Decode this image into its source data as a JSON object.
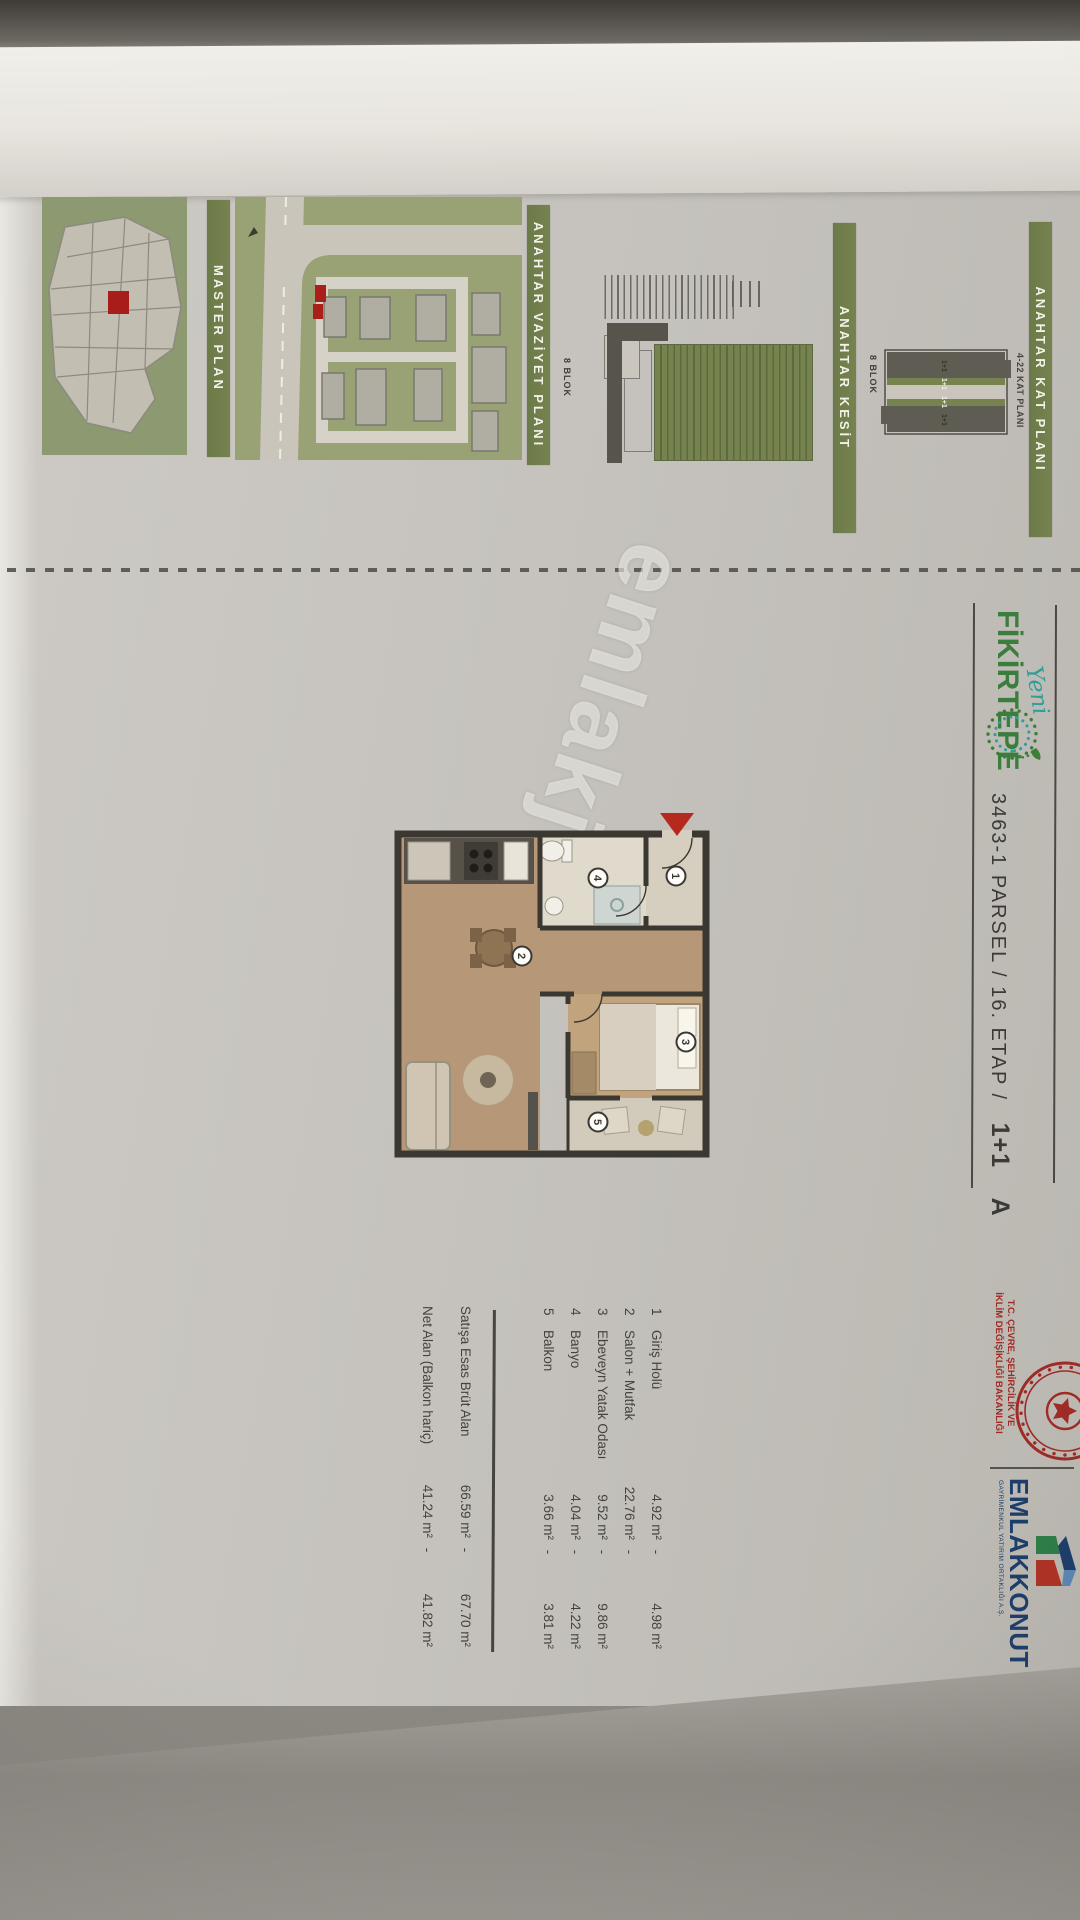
{
  "photo": {
    "watermark": "emlakjet.com"
  },
  "header": {
    "brand_script": "Yeni",
    "brand": "FİKİRTEPE",
    "title": "3463-1 PARSEL / 16. ETAP /",
    "unit_type": "1+1",
    "variant": "A"
  },
  "ministry": {
    "line1": "T.C. ÇEVRE, ŞEHİRCİLİK VE",
    "line2": "İKLİM DEĞİŞİKLİĞİ BAKANLIĞI"
  },
  "developer": {
    "name": "EMLAKKONUT",
    "subtitle": "GAYRİMENKUL YATIRIM ORTAKLIĞI A.Ş."
  },
  "key_plans": {
    "kat_plani": {
      "label": "ANAHTAR KAT PLANI",
      "caption": "4-22 KAT PLANI",
      "block": "8 BLOK",
      "units": [
        "1+1",
        "1+1",
        "1+1",
        "1+1"
      ]
    },
    "kesit": {
      "label": "ANAHTAR KESİT",
      "block": "8 BLOK"
    },
    "vaziyet": {
      "label": "ANAHTAR VAZİYET PLANI"
    },
    "master": {
      "label": "MASTER PLAN"
    }
  },
  "plan": {
    "rooms": [
      "1",
      "2",
      "3",
      "4",
      "5"
    ]
  },
  "schedule": {
    "rows": [
      {
        "no": "1",
        "name": "Giriş Holü",
        "area1": "4.92 m²",
        "sep": "-",
        "area2": "4.98 m²"
      },
      {
        "no": "2",
        "name": "Salon + Mutfak",
        "area1": "22.76 m²",
        "sep": "-",
        "area2": ""
      },
      {
        "no": "3",
        "name": "Ebeveyn Yatak Odası",
        "area1": "9.52 m²",
        "sep": "-",
        "area2": "9.86 m²"
      },
      {
        "no": "4",
        "name": "Banyo",
        "area1": "4.04 m²",
        "sep": "-",
        "area2": "4.22 m²"
      },
      {
        "no": "5",
        "name": "Balkon",
        "area1": "3.66 m²",
        "sep": "-",
        "area2": "3.81 m²"
      }
    ],
    "totals": [
      {
        "label": "Satışa Esas Brüt Alan",
        "area1": "66.59 m²",
        "sep": "-",
        "area2": "67.70 m²"
      },
      {
        "label": "Net Alan (Balkon hariç)",
        "area1": "41.24 m²",
        "sep": "-",
        "area2": "41.82 m²"
      }
    ]
  }
}
